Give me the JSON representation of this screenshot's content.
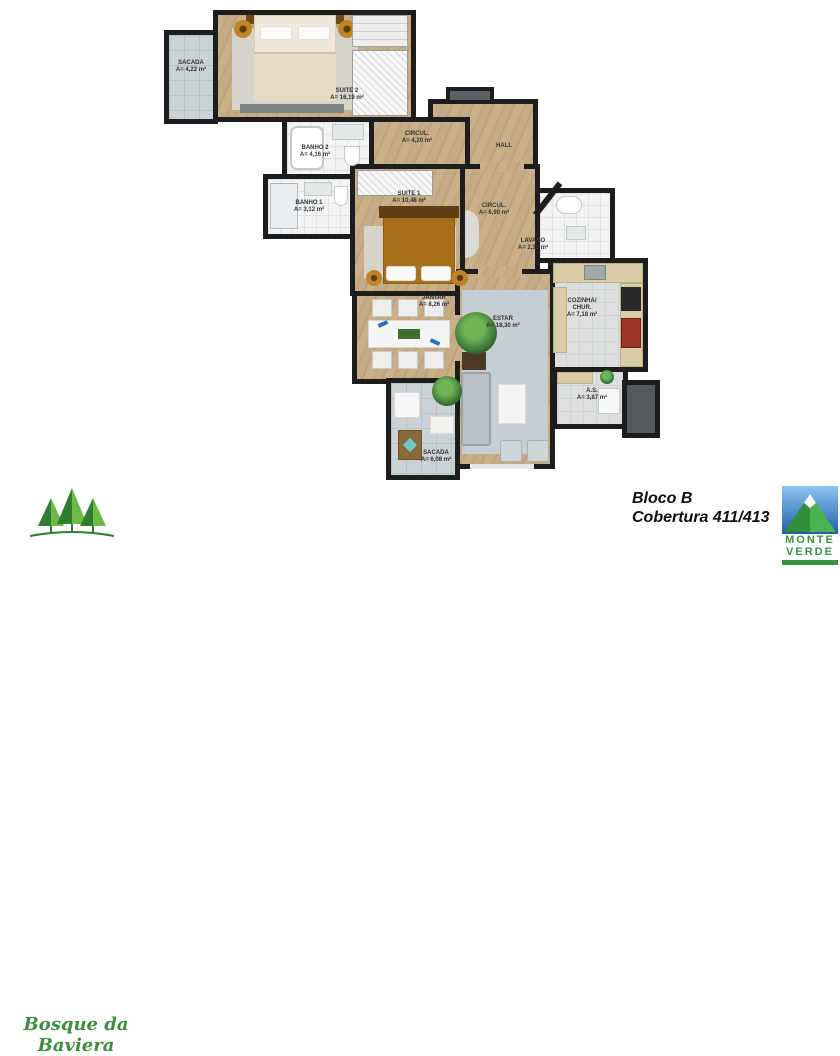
{
  "plan": {
    "rooms": [
      {
        "id": "sacada_top",
        "name": "SACADA",
        "area": "A= 4,22 m²"
      },
      {
        "id": "suite2",
        "name": "SUITE 2",
        "area": "A= 16,19 m²"
      },
      {
        "id": "banho2",
        "name": "BANHO 2",
        "area": "A= 4,16 m²"
      },
      {
        "id": "banho1",
        "name": "BANHO 1",
        "area": "A= 3,12 m²"
      },
      {
        "id": "circul1",
        "name": "CIRCUL.",
        "area": "A= 4,20 m²"
      },
      {
        "id": "hall",
        "name": "HALL",
        "area": ""
      },
      {
        "id": "suite1",
        "name": "SUITE 1",
        "area": "A= 10,48 m²"
      },
      {
        "id": "circul2",
        "name": "CIRCUL.",
        "area": "A= 6,90 m²"
      },
      {
        "id": "lavabo",
        "name": "LAVABO",
        "area": "A= 2,15 m²"
      },
      {
        "id": "cozinha",
        "name": "COZINHA/ CHUR.",
        "area": "A= 7,18 m²"
      },
      {
        "id": "jantar",
        "name": "JANTAR",
        "area": "A= 8,26 m²"
      },
      {
        "id": "estar",
        "name": "ESTAR",
        "area": "A= 18,30 m²"
      },
      {
        "id": "as",
        "name": "A.S.",
        "area": "A= 3,87 m²"
      },
      {
        "id": "sacada_bottom",
        "name": "SACADA",
        "area": "A= 6,08 m²"
      }
    ]
  },
  "footer": {
    "development_name": "Bosque da Baviera",
    "block_label": "Bloco B",
    "unit_label": "Cobertura 411/413",
    "builder_name_line1": "MONTE",
    "builder_name_line2": "VERDE"
  },
  "colors": {
    "wall": "#1d1d1d",
    "wood_floor": "#c7ae89",
    "bath_tile": "#f2f3f2",
    "balcony_tile": "#cbd2d5",
    "brand_green": "#3e8e3e",
    "logo_blue": "#1d5fae",
    "accent_blue": "#2f6fb3"
  }
}
